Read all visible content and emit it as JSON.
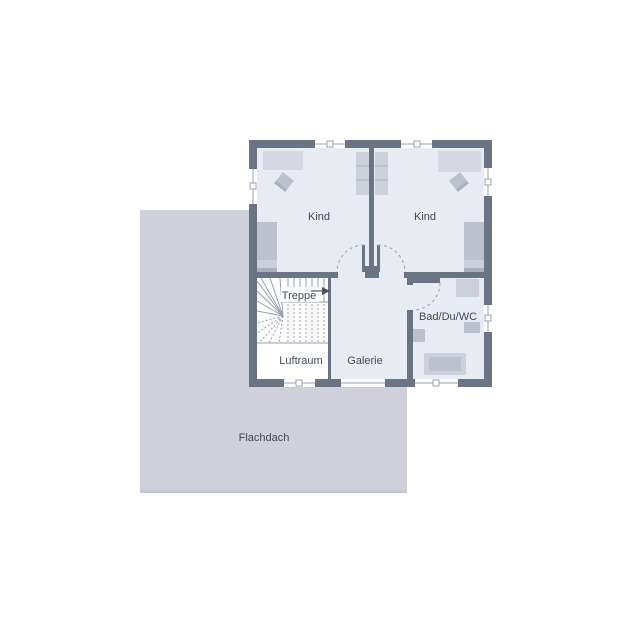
{
  "colors": {
    "wall": "#6b7484",
    "floor": "#e9ebf2",
    "roof": "#cfd0d9",
    "roof_edge": "#c5c6cf",
    "furn_light": "#d5d8e2",
    "furn_band": "#ccd0da",
    "furn_mid": "#bcc1cd",
    "furn_dark": "#aab0be",
    "line": "#9ba1ad",
    "stair": "#979dab",
    "label": "#414a59",
    "arrow": "#4a5260"
  },
  "rooms": {
    "kind_left": {
      "label": "Kind"
    },
    "kind_right": {
      "label": "Kind"
    },
    "treppe": {
      "label": "Treppe"
    },
    "luftraum": {
      "label": "Luftraum"
    },
    "galerie": {
      "label": "Galerie"
    },
    "bad": {
      "label": "Bad/Du/WC"
    }
  },
  "roof": {
    "label": "Flachdach"
  }
}
